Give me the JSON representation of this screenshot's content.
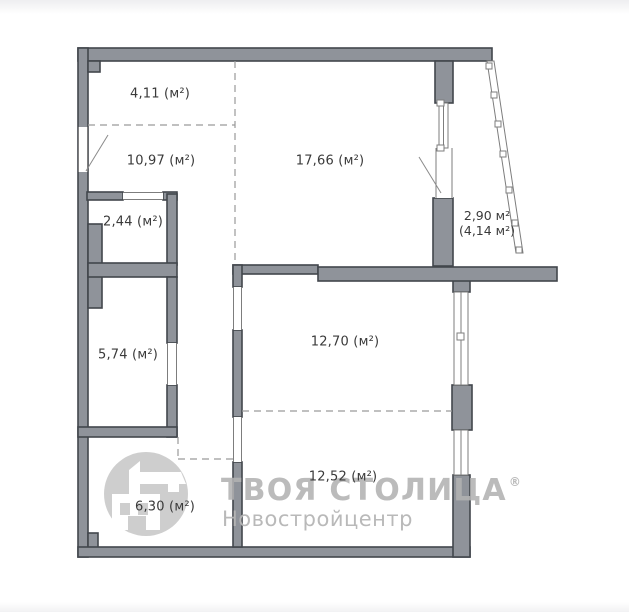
{
  "plan": {
    "title": "apartment floor plan",
    "rooms": {
      "hall_top": {
        "label": "4,11 (м²)"
      },
      "hall": {
        "label": "10,97 (м²)"
      },
      "living": {
        "label": "17,66 (м²)"
      },
      "bathroom": {
        "label": "2,44 (м²)"
      },
      "kitchen": {
        "label": "5,74 (м²)"
      },
      "room_12_70": {
        "label": "12,70 (м²)"
      },
      "room_12_52": {
        "label": "12,52 (м²)"
      },
      "room_6_30": {
        "label": "6,30 (м²)"
      },
      "balcony": {
        "label_line1": "2,90 м²",
        "label_line2": "(4,14 м²)"
      }
    },
    "colors": {
      "wall_fill": "#8F939A",
      "wall_stroke": "#42464C",
      "thin_line": "#7D7D7D",
      "dash_color": "#9A9A9A",
      "label_text": "#3A3A3A",
      "background": "#FFFFFF"
    }
  },
  "watermark": {
    "brand": "ТВОЯ СТОЛИЦА",
    "registered_mark": "®",
    "subtitle": "Новостройцентр",
    "colors": {
      "brand_text": "#B2B2B2",
      "subtitle_text": "#B6B6B6",
      "logo_circle": "#C9C9C9"
    }
  }
}
